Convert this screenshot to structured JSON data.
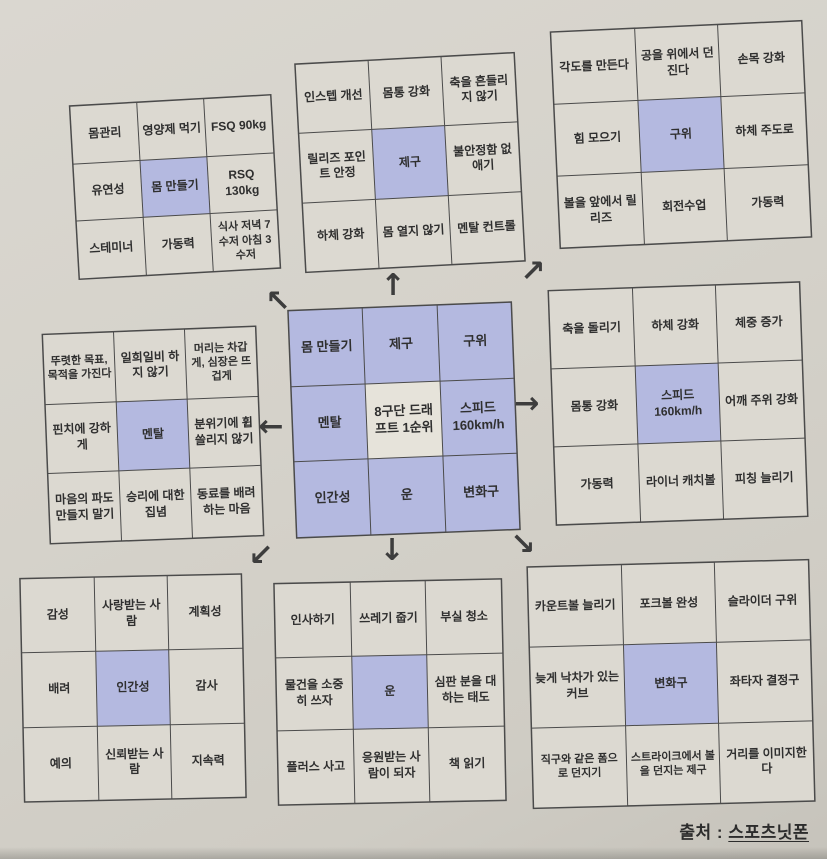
{
  "title": "만다라트 목표 달성 차트",
  "caption": {
    "prefix": "출처 : ",
    "source": "스포츠닛폰"
  },
  "colors": {
    "highlight": "#b4b9e0",
    "cell": "#dcd9d1",
    "background": "#d5d2ca",
    "line": "#4b4b4b"
  },
  "grids": [
    {
      "name": "몸 만들기",
      "highlight_index": 4,
      "cells": [
        "몸관리",
        "영양제 먹기",
        "FSQ 90kg",
        "유연성",
        "몸 만들기",
        "RSQ 130kg",
        "스테미너",
        "가동력",
        "식사 저녁 7수저 아침 3수저"
      ]
    },
    {
      "name": "제구",
      "highlight_index": 4,
      "cells": [
        "인스텝 개선",
        "몸통 강화",
        "축을 흔들리지 않기",
        "릴리즈 포인트 안정",
        "제구",
        "불안정함 없애기",
        "하체 강화",
        "몸 열지 않기",
        "멘탈 컨트롤"
      ]
    },
    {
      "name": "구위",
      "highlight_index": 4,
      "cells": [
        "각도를 만든다",
        "공을 위에서 던진다",
        "손목 강화",
        "힘 모으기",
        "구위",
        "하체 주도로",
        "볼을 앞에서 릴리즈",
        "회전수업",
        "가동력"
      ]
    },
    {
      "name": "멘탈",
      "highlight_index": 4,
      "cells": [
        "뚜렷한 목표, 목적을 가진다",
        "일희일비 하지 않기",
        "머리는 차갑게, 심장은 뜨겁게",
        "핀치에 강하게",
        "멘탈",
        "분위기에 휩쓸리지 않기",
        "마음의 파도 만들지 말기",
        "승리에 대한 집념",
        "동료를 배려하는 마음"
      ]
    },
    {
      "name": "8구단 드래프트 1순위",
      "highlight_index": -1,
      "cells": [
        "몸 만들기",
        "제구",
        "구위",
        "멘탈",
        "8구단 드래프트 1순위",
        "스피드 160km/h",
        "인간성",
        "운",
        "변화구"
      ]
    },
    {
      "name": "스피드 160km/h",
      "highlight_index": 4,
      "cells": [
        "축을 돌리기",
        "하체 강화",
        "체중 증가",
        "몸통 강화",
        "스피드 160km/h",
        "어깨 주위 강화",
        "가동력",
        "라이너 캐치볼",
        "피칭 늘리기"
      ]
    },
    {
      "name": "인간성",
      "highlight_index": 4,
      "cells": [
        "감성",
        "사랑받는 사람",
        "계획성",
        "배려",
        "인간성",
        "감사",
        "예의",
        "신뢰받는 사람",
        "지속력"
      ]
    },
    {
      "name": "운",
      "highlight_index": 4,
      "cells": [
        "인사하기",
        "쓰레기 줍기",
        "부실 청소",
        "물건을 소중히 쓰자",
        "운",
        "심판 분을 대하는 태도",
        "플러스 사고",
        "응원받는 사람이 되자",
        "책 읽기"
      ]
    },
    {
      "name": "변화구",
      "highlight_index": 4,
      "cells": [
        "카운트볼 늘리기",
        "포크볼 완성",
        "슬라이더 구위",
        "늦게 낙차가 있는 커브",
        "변화구",
        "좌타자 결정구",
        "직구와 같은 폼으로 던지기",
        "스트라이크에서 볼을 던지는 제구",
        "거리를 이미지한다"
      ]
    }
  ],
  "arrows": [
    {
      "name": "arrow-up-left",
      "glyph": "↖"
    },
    {
      "name": "arrow-up",
      "glyph": "↑"
    },
    {
      "name": "arrow-up-right",
      "glyph": "↗"
    },
    {
      "name": "arrow-left",
      "glyph": "←"
    },
    {
      "name": "arrow-right",
      "glyph": "→"
    },
    {
      "name": "arrow-down-left",
      "glyph": "↙"
    },
    {
      "name": "arrow-down",
      "glyph": "↓"
    },
    {
      "name": "arrow-down-right",
      "glyph": "↘"
    }
  ]
}
